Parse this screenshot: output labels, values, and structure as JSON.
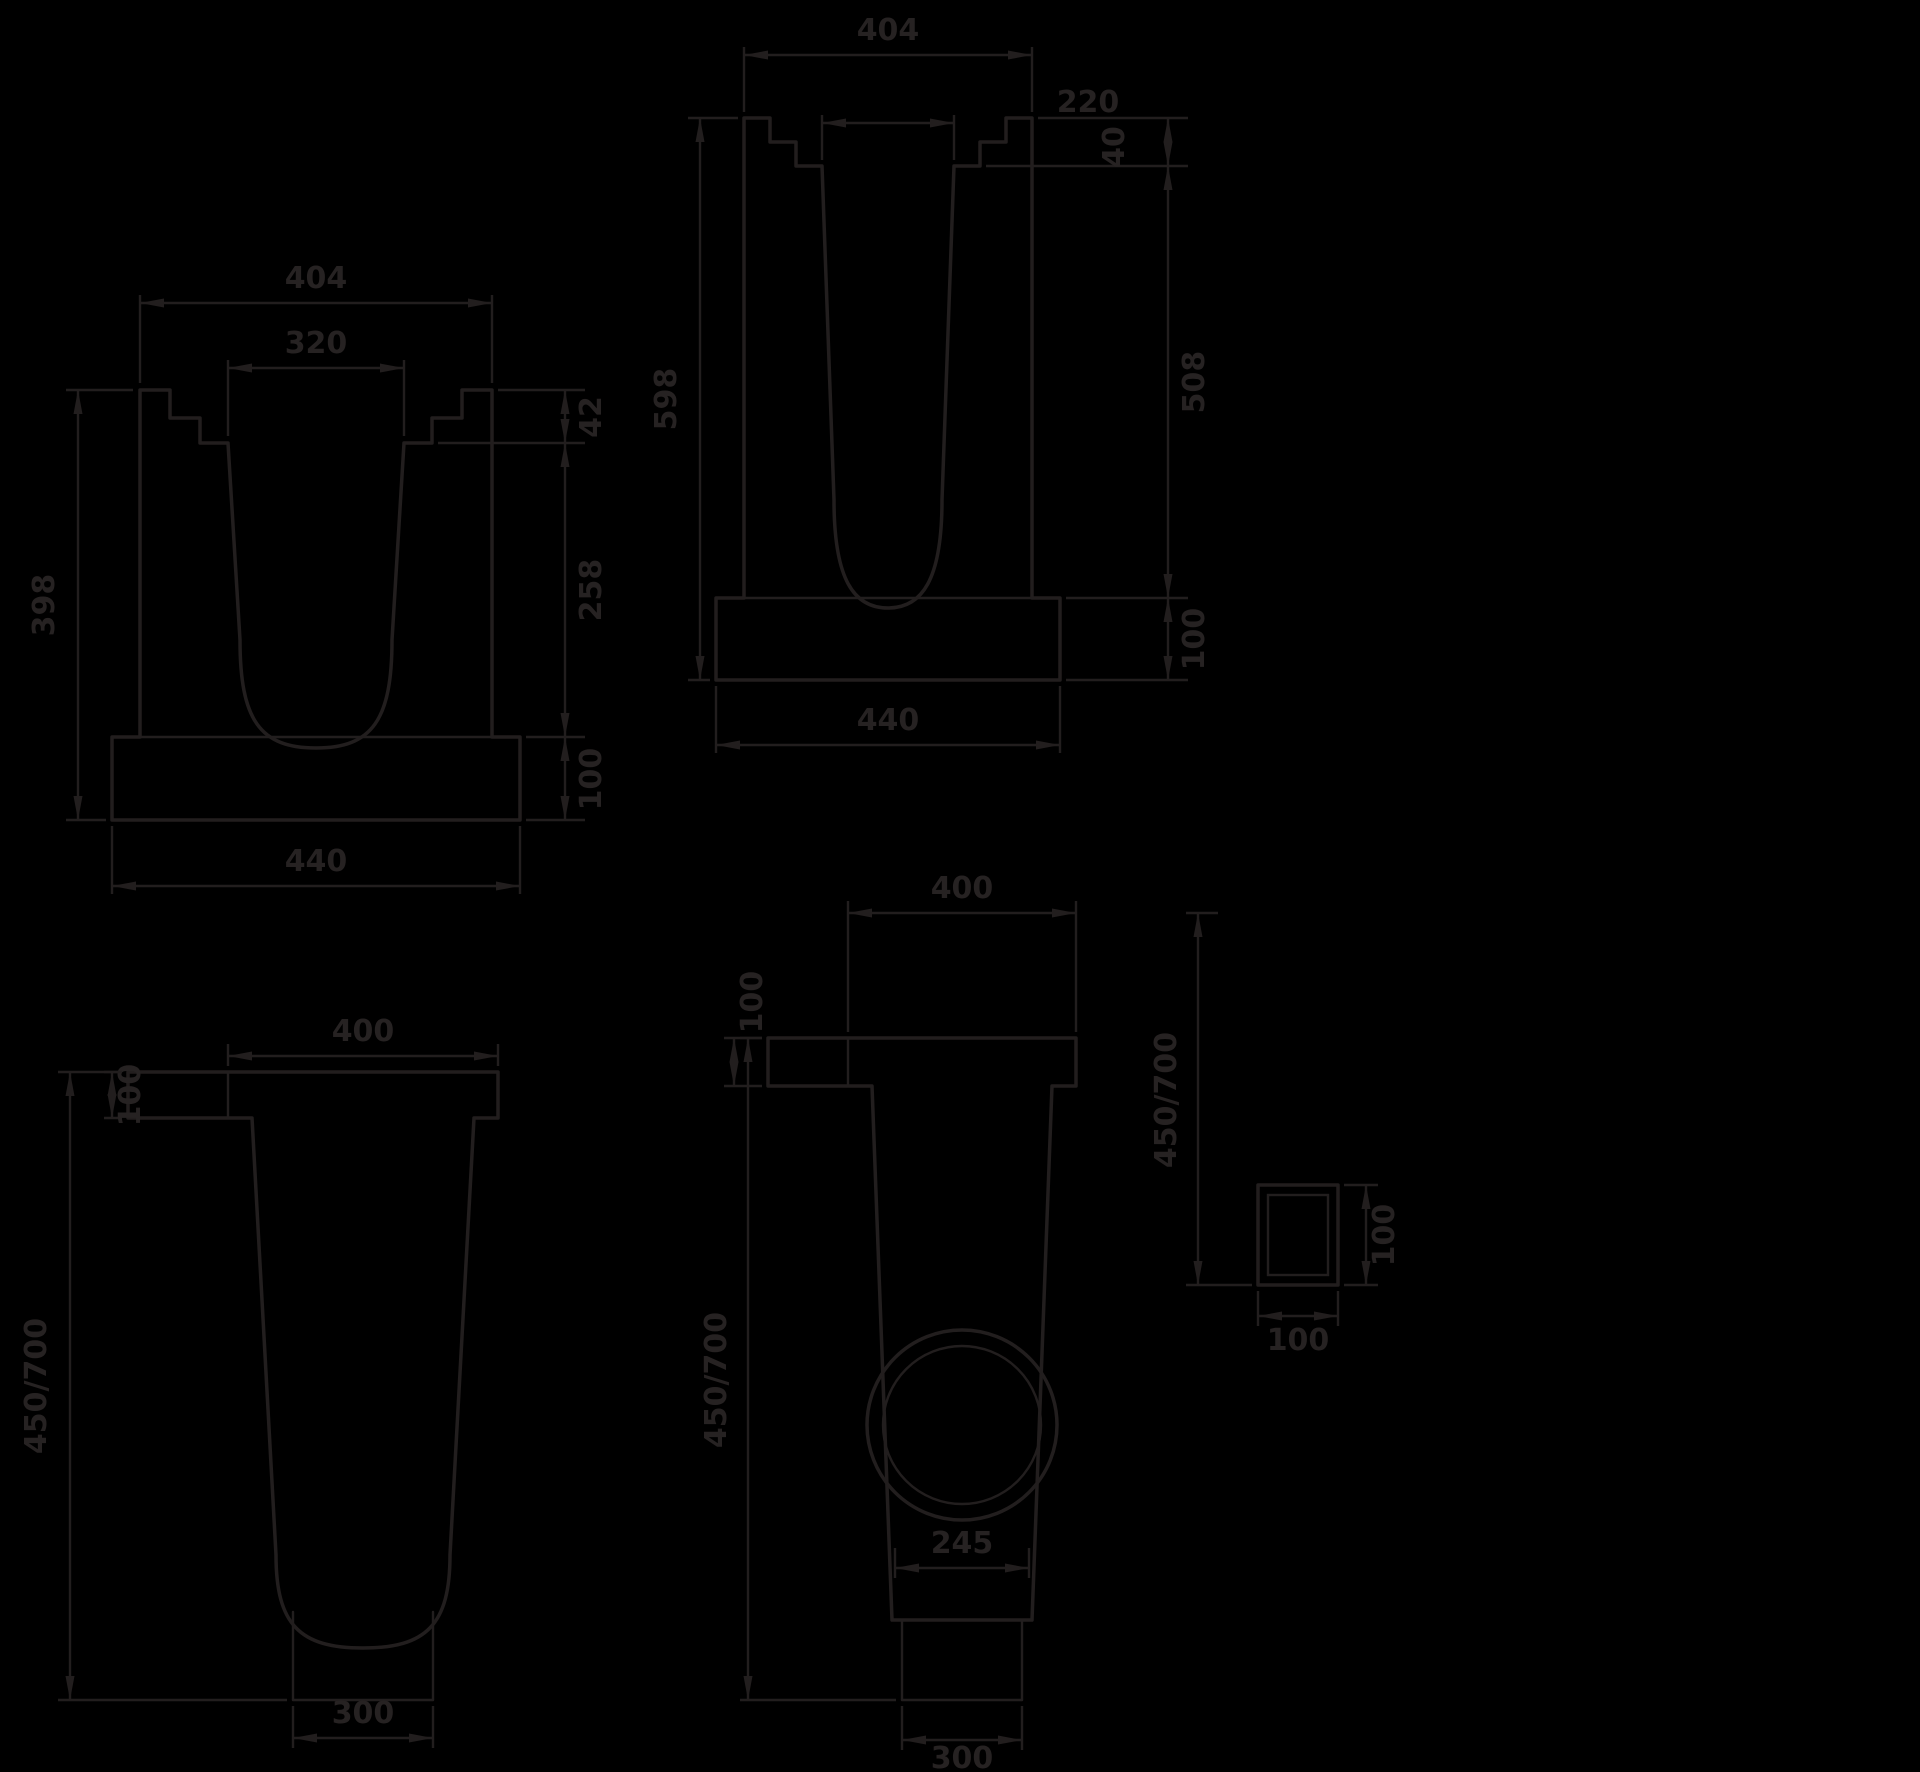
{
  "page": {
    "background": "#000000",
    "line_color": "#221e1e",
    "text_color": "#262222",
    "description": "Technical dimension drawing: drainage channel cross-sections and sand trap views"
  },
  "channel_small": {
    "top_width": "404",
    "inner_width": "320",
    "overall_height": "398",
    "lip_height": "42",
    "inner_depth": "258",
    "base_height": "100",
    "bottom_width": "440"
  },
  "channel_tall": {
    "top_width": "404",
    "inner_width": "220",
    "overall_height": "598",
    "lip_height": "40",
    "inner_depth": "508",
    "base_height": "100",
    "bottom_width": "440"
  },
  "sand_trap_side": {
    "top_width": "400",
    "inlet_height": "100",
    "overall_height": "450/700",
    "bottom_width": "300"
  },
  "sand_trap_front": {
    "top_width": "400",
    "inlet_height": "100",
    "overall_height": "450/700",
    "outlet_diameter": "245",
    "bottom_width": "300"
  },
  "outlet_detail": {
    "depth_to_invert": "450/700",
    "outlet_height": "100",
    "outlet_width": "100"
  }
}
